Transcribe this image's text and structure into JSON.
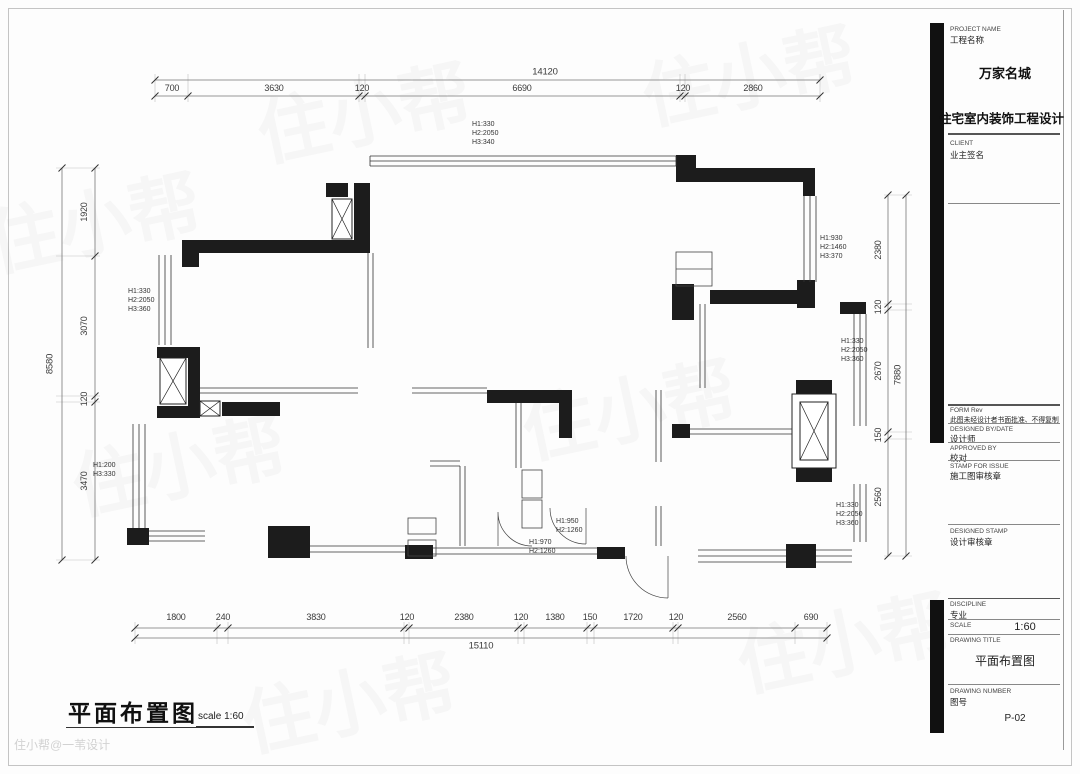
{
  "title_block": {
    "project_name_label_en": "PROJECT NAME",
    "project_name_label_cn": "工程名称",
    "project_name": "万家名城",
    "project_type": "住宅室内装饰工程设计",
    "client_label_en": "CLIENT",
    "client_label_cn": "业主签名",
    "form_label": "FORM Rev",
    "form_note": "此图未经设计者书面批准、不得复制",
    "designed_by_label": "DESIGNED BY/DATE",
    "designed_by": "设计师",
    "approved_by_label": "APPROVED BY",
    "approved_by": "校对",
    "stamp_label": "STAMP FOR ISSUE",
    "stamp": "施工图审核章",
    "designed_stamp_label": "DESIGNED STAMP",
    "designed_stamp": "设计审核章",
    "discipline_label": "DISCIPLINE",
    "discipline": "专业",
    "scale_label": "SCALE",
    "scale_value": "1:60",
    "drawing_title_label": "DRAWING TITLE",
    "drawing_title": "平面布置图",
    "drawing_number_label": "DRAWING NUMBER",
    "drawing_number_label_cn": "图号",
    "drawing_number": "P-02"
  },
  "footer": {
    "title": "平面布置图",
    "scale_note": "scale 1:60",
    "watermark": "住小帮@一苇设计"
  },
  "watermark": {
    "brand": "住小帮"
  },
  "dimensions": {
    "top": {
      "total": "14120",
      "segments": [
        "700",
        "3630",
        "120",
        "6690",
        "120",
        "2860"
      ]
    },
    "bottom": {
      "total": "15110",
      "segments": [
        "1800",
        "240",
        "3830",
        "120",
        "2380",
        "120",
        "1380",
        "150",
        "1720",
        "120",
        "2560",
        "690"
      ]
    },
    "left": {
      "total": "8580",
      "segments": [
        "1920",
        "3070",
        "120",
        "3470"
      ]
    },
    "right": {
      "total": "7880",
      "segments": [
        "2380",
        "120",
        "2670",
        "150",
        "2560"
      ]
    }
  },
  "annotations": [
    {
      "text": "H1:330\nH2:2050\nH3:340"
    },
    {
      "text": "H1:330\nH2:2050\nH3:360"
    },
    {
      "text": "H1:930\nH2:1460\nH3:370"
    },
    {
      "text": "H1:330\nH2:2050\nH3:360"
    },
    {
      "text": "H1:200\nH3:330"
    },
    {
      "text": "H1:950\nH2:1260"
    },
    {
      "text": "H1:970\nH2:1260"
    },
    {
      "text": "H1:330\nH2:2050\nH3:360"
    }
  ]
}
